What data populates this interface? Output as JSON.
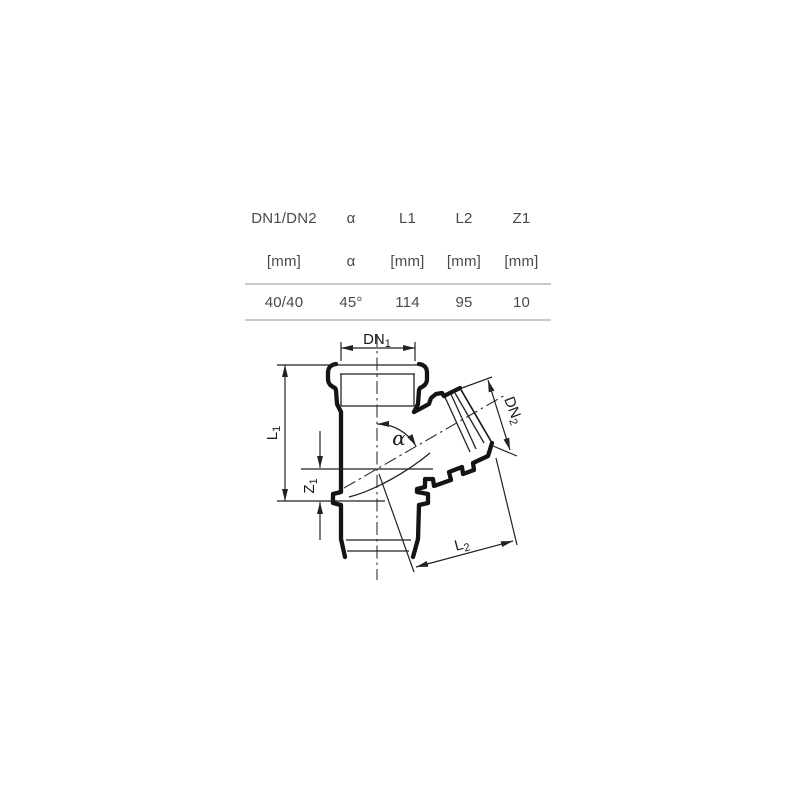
{
  "table": {
    "columns": [
      {
        "header": "DN1/DN2",
        "unit": "[mm]",
        "value": "40/40"
      },
      {
        "header": "α",
        "unit": "α",
        "value": "45°"
      },
      {
        "header": "L1",
        "unit": "[mm]",
        "value": "114"
      },
      {
        "header": "L2",
        "unit": "[mm]",
        "value": "95"
      },
      {
        "header": "Z1",
        "unit": "[mm]",
        "value": "10"
      }
    ]
  },
  "diagram": {
    "labels": {
      "dn1_main": "DN",
      "dn1_sub": "1",
      "dn2_main": "DN",
      "dn2_sub": "2",
      "l1_main": "L",
      "l1_sub": "1",
      "l2_main": "L",
      "l2_sub": "2",
      "z1_main": "Z",
      "z1_sub": "1",
      "alpha": "α"
    },
    "colors": {
      "outline": "#141414",
      "dimension_lines": "#222222",
      "table_text": "#4a4a4a",
      "table_rule": "#c9c9c9",
      "background": "#ffffff"
    }
  }
}
